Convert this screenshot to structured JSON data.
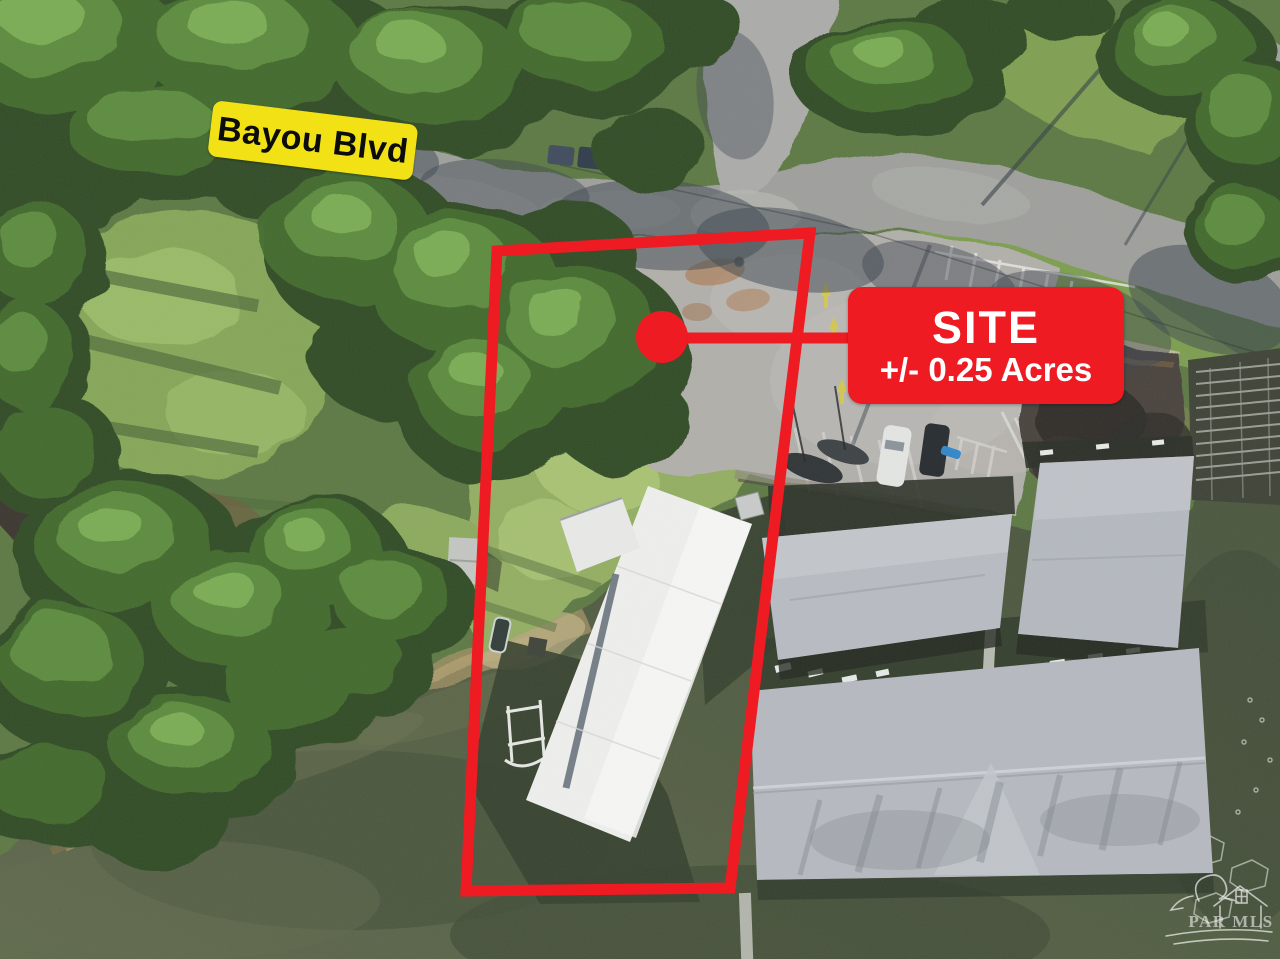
{
  "annotations": {
    "street_label": {
      "text": "Bayou Blvd",
      "bg_color": "#f2e115",
      "text_color": "#0c0c0c"
    },
    "site_label": {
      "title": "SITE",
      "subtitle": "+/- 0.25 Acres",
      "bg_color": "#ee1b22",
      "text_color": "#ffffff"
    },
    "site_outline": {
      "points": "497,251 810,233 730,888 466,891",
      "color": "#ee1b22",
      "stroke_width": "11"
    },
    "marker_dot": {
      "cx": "662",
      "cy": "337",
      "r": "26",
      "color": "#ee1b22"
    },
    "callout_line": {
      "x1": "662",
      "y1": "338",
      "x2": "854",
      "y2": "338",
      "color": "#ee1b22",
      "stroke_width": "11"
    }
  },
  "watermark": {
    "text": "PAR MLS",
    "color": "#ffffff"
  }
}
